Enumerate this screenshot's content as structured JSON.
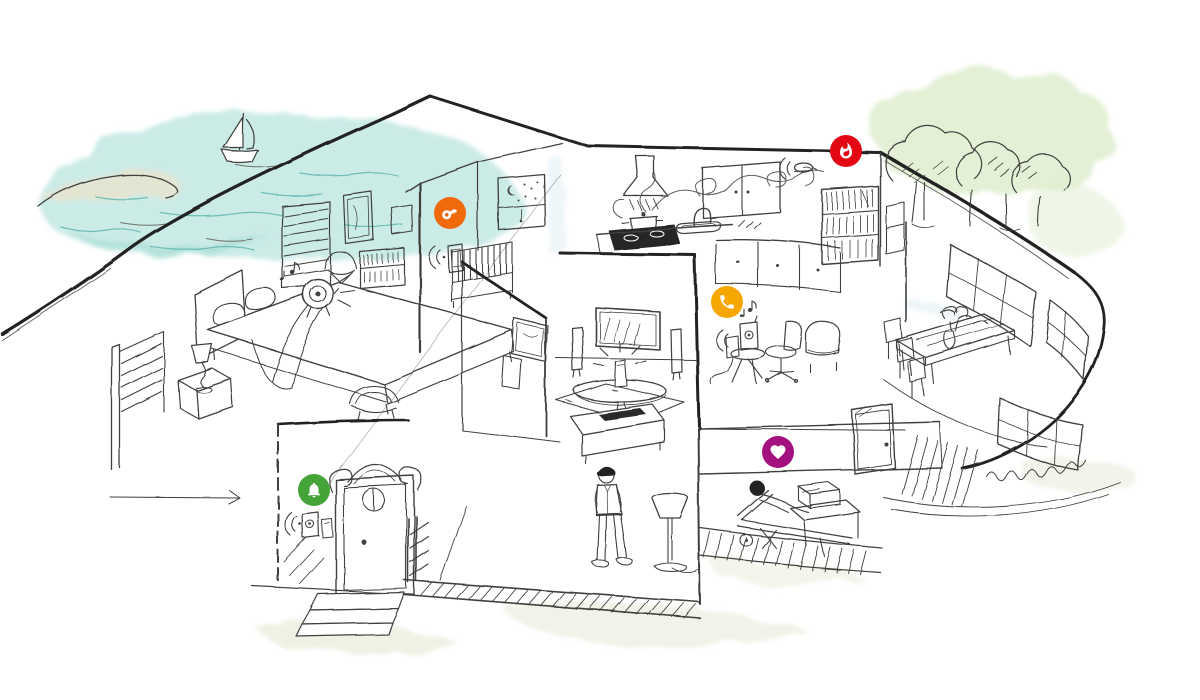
{
  "canvas": {
    "width": 1200,
    "height": 700,
    "background": "#ffffff"
  },
  "illustration": {
    "kind": "hand-drawn smart home cutaway sketch",
    "style": "ink line drawing with watercolor washes",
    "no_visible_text": true
  },
  "palette": {
    "ink": "#3f3f3c",
    "ink_heavy": "#232323",
    "water": "#bce5e0",
    "water_deep": "#9fd8d0",
    "wave": "#5fb8ae",
    "land": "#e8e4cf",
    "foliage_wash": "#dcecca",
    "ground_wash": "#e9ead8",
    "interior_hint": "#ddeef5",
    "dark_fill": "#262626"
  },
  "hotspots": [
    {
      "name": "access-hotspot",
      "icon": "key-icon",
      "color": "#F0690A",
      "x": 450,
      "y": 213,
      "depicts": "smart access / lock in nursery"
    },
    {
      "name": "fire-hotspot",
      "icon": "flame-icon",
      "color": "#E30613",
      "x": 846,
      "y": 151,
      "depicts": "smoke / fire alarm above kitchen"
    },
    {
      "name": "phone-hotspot",
      "icon": "phone-icon",
      "color": "#F7A600",
      "x": 727,
      "y": 302,
      "depicts": "phone / audio dock in lounge"
    },
    {
      "name": "health-hotspot",
      "icon": "heart-icon",
      "color": "#A3117E",
      "x": 778,
      "y": 452,
      "depicts": "health device on terrace"
    },
    {
      "name": "doorbell-hotspot",
      "icon": "bell-icon",
      "color": "#44A437",
      "x": 314,
      "y": 490,
      "depicts": "smart doorbell at entrance"
    }
  ],
  "devices": [
    {
      "name": "nursery-wall-device",
      "x": 455,
      "y": 258,
      "wifi_waves": true
    },
    {
      "name": "smoke-detector",
      "x": 804,
      "y": 168,
      "wifi_waves": true
    },
    {
      "name": "audio-dock",
      "x": 748,
      "y": 337,
      "wifi_waves": true
    },
    {
      "name": "video-doorbell",
      "x": 310,
      "y": 525,
      "wifi_waves": true
    },
    {
      "name": "terrace-health-box",
      "x": 818,
      "y": 494,
      "wifi_waves": false
    },
    {
      "name": "bedside-speaker",
      "x": 318,
      "y": 294,
      "wifi_waves": false
    }
  ],
  "scene_regions": [
    {
      "name": "lake-view-with-sailboat",
      "area": "top-left"
    },
    {
      "name": "bedroom-with-bed-and-nightstand",
      "area": "left"
    },
    {
      "name": "nursery-with-crib-and-moon-window",
      "area": "upper-middle-left"
    },
    {
      "name": "living-room-tv-speakers-coffee-table",
      "area": "center"
    },
    {
      "name": "kitchen-stove-pot-steam-sink-cabinets",
      "area": "upper-middle-right"
    },
    {
      "name": "lounge-corner-chair-and-dock",
      "area": "middle-right"
    },
    {
      "name": "dining-table-in-curved-sunroom",
      "area": "right"
    },
    {
      "name": "trees",
      "area": "top-right"
    },
    {
      "name": "entrance-door-with-steps",
      "area": "bottom-left"
    },
    {
      "name": "terrace-with-lounger-person",
      "area": "bottom-right"
    },
    {
      "name": "standing-man-and-floor-lamp",
      "area": "bottom-center"
    }
  ]
}
